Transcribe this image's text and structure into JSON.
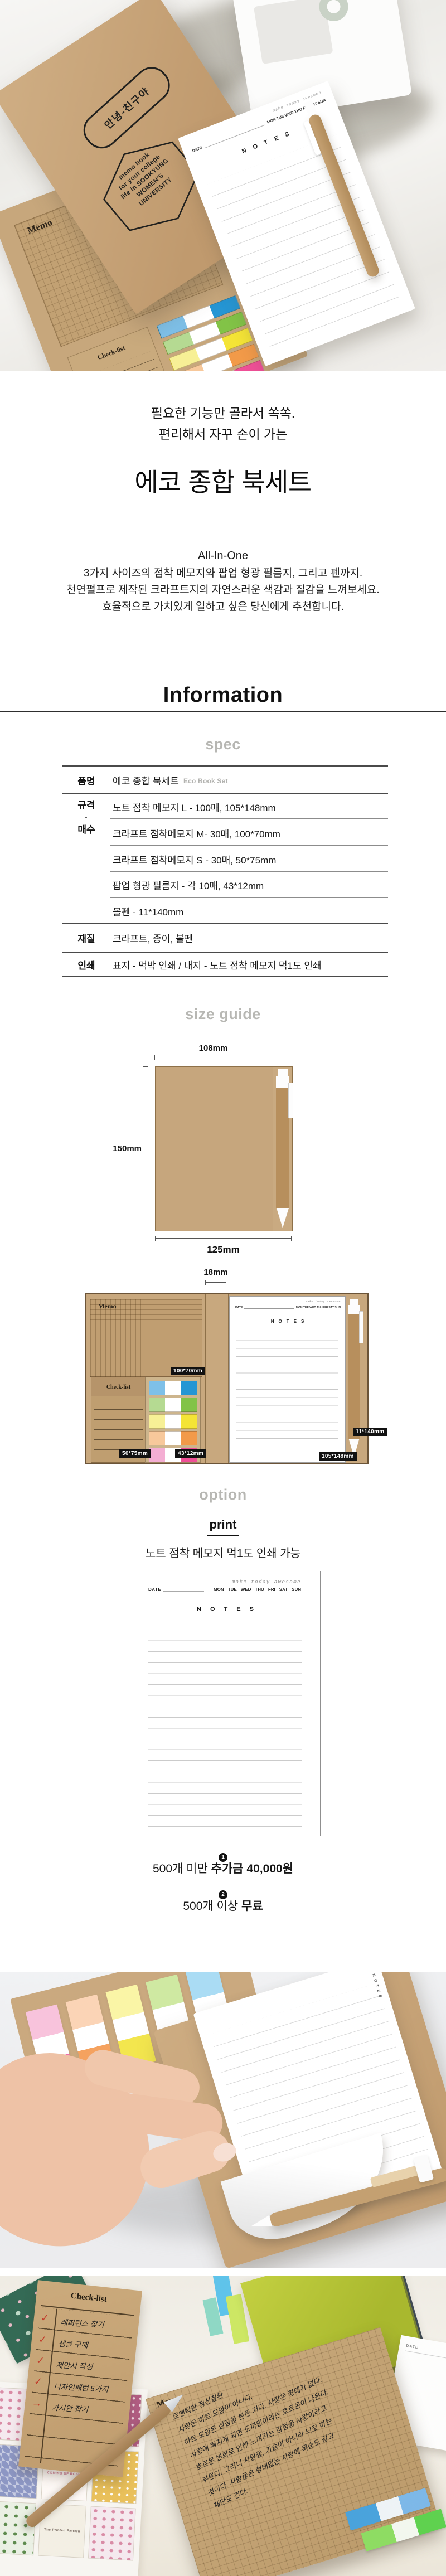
{
  "colors": {
    "kraft": "#c8a87e",
    "kraft_dark": "#b78f5d",
    "heading_gray": "#b7b7b3",
    "table_line": "#4a4a4a",
    "flag_blue_light": "#7ec0e8",
    "flag_blue_dark": "#2596d4",
    "flag_green_light": "#b5da92",
    "flag_green_dark": "#82c347",
    "flag_yellow_light": "#f7f096",
    "flag_yellow_dark": "#f4e436",
    "flag_orange_light": "#f7c89b",
    "flag_orange_dark": "#f29a49",
    "flag_pink_light": "#f4aed3",
    "flag_pink_dark": "#ef4f97"
  },
  "photo1": {
    "stamp_oval": "안녕-친구야",
    "stamp_hex": [
      "memo book",
      "for your college",
      "life in SOOKYUNG",
      "WOMEN'S",
      "UNIVERSITY"
    ],
    "memo_title": "Memo",
    "checklist_title": "Check-list",
    "notes": {
      "tagline": "make today awesome",
      "date_label": "DATE",
      "days": "MON TUE WED THU FRI SAT SUN",
      "title": "NOTES"
    }
  },
  "intro": {
    "catch1": "필요한 기능만 골라서 쏙쏙.",
    "catch2": "편리해서 자꾸 손이 가는",
    "title": "에코 종합 북세트",
    "subtitle": "All-In-One",
    "desc1": "3가지 사이즈의 점착 메모지와 팝업 형광 필름지, 그리고 펜까지.",
    "desc2": "천연펄프로 제작된 크라프트지의 자연스러운 색감과 질감을 느껴보세요.",
    "desc3": "효율적으로 가치있게 일하고 싶은 당신에게 추천합니다."
  },
  "information": {
    "heading": "Information",
    "subheading": "spec",
    "table": {
      "product": {
        "label": "품명",
        "value": "에코 종합 북세트",
        "value_en": "Eco Book Set"
      },
      "size": {
        "label1": "규격",
        "dot": "·",
        "label2": "매수",
        "values": [
          "노트 점착 메모지 L - 100매, 105*148mm",
          "크라프트 점착메모지 M- 30매, 100*70mm",
          "크라프트 점착메모지 S - 30매, 50*75mm",
          "팝업 형광 필름지 - 각 10매, 43*12mm",
          "볼펜 - 11*140mm"
        ]
      },
      "material": {
        "label": "재질",
        "value": "크라프트, 종이, 볼펜"
      },
      "print": {
        "label": "인쇄",
        "value": "표지 - 먹박 인쇄 / 내지 - 노트 점착 메모지 먹1도 인쇄"
      }
    }
  },
  "size_guide": {
    "heading": "size guide",
    "closed": {
      "top": "108mm",
      "left": "150mm",
      "bottom": "125mm"
    },
    "open": {
      "spine": "18mm",
      "memo_title": "Memo",
      "memo_size": "100*70mm",
      "checklist_title": "Check-list",
      "checklist_size": "50*75mm",
      "flags_size": "43*12mm",
      "notes_size": "105*148mm",
      "pen_size": "11*140mm",
      "notes": {
        "tagline": "make today awesome",
        "date_label": "DATE",
        "days": "MON TUE WED THU FRI SAT SUN",
        "title": "NOTES"
      }
    }
  },
  "option": {
    "heading": "option",
    "print_title": "print",
    "description": "노트 점착 메모지 먹1도 인쇄 가능",
    "preview": {
      "tagline": "make today awesome",
      "date_label": "DATE",
      "days": [
        "MON",
        "TUE",
        "WED",
        "THU",
        "FRI",
        "SAT",
        "SUN"
      ],
      "title": "NOTES"
    },
    "pricing": [
      {
        "badge": "1",
        "prefix": "500개 미만 ",
        "bold": "추가금 40,000원"
      },
      {
        "badge": "2",
        "prefix": "500개 이상 ",
        "bold": "무료"
      }
    ]
  },
  "photo2": {
    "notes_title": "NOTES"
  },
  "photo3": {
    "checklist": {
      "title": "Check-list",
      "items": [
        "레퍼런스 찾기",
        "샘플 구매",
        "제안서 작성",
        "디자인패턴 5가지",
        "가시안 잡기"
      ],
      "marks": [
        "✓",
        "✓",
        "✓",
        "✓",
        "→"
      ]
    },
    "memo": {
      "title": "Memo",
      "lines": [
        "로맨틱한 정신질환",
        "사랑은 하트 모양이 아니다.",
        "하트 모양은 심장을 본뜬 거다. 사랑은 형태가 없다.",
        "사랑에 빠지게 되면 도파민이라는 호르몬이 나온다.",
        "호르몬 변화로 인해 느껴지는 감정을 사랑이라고",
        "부른다. 그러니 사랑을, 가슴이 아니라 뇌로 하는",
        "것이다. 사람들은 형태없는 사랑에 목숨도 걸고",
        "재단도 건다."
      ]
    },
    "books": [
      "THE PRINTED SQUARE",
      "COMING UP ROSES",
      "The Printed Pattern"
    ],
    "date_label": "DATE"
  }
}
